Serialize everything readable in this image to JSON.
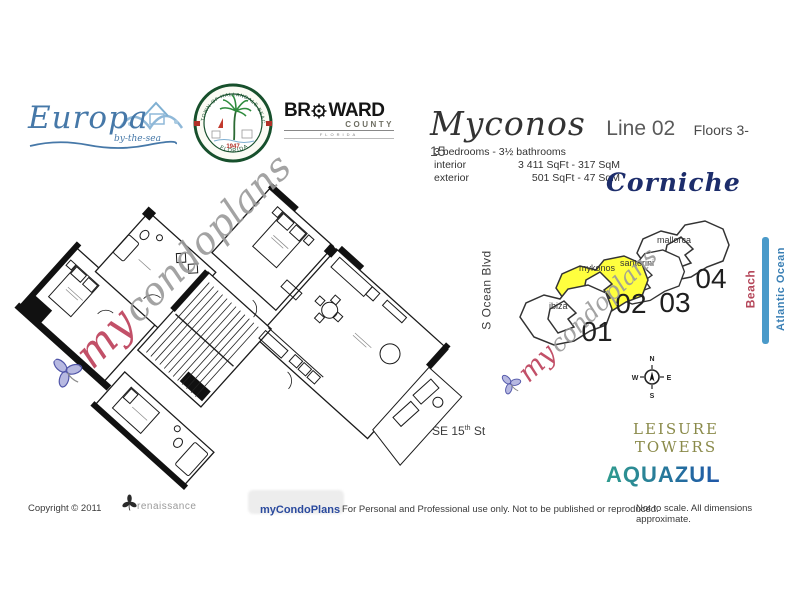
{
  "logos": {
    "europa": {
      "name": "Europa",
      "tagline": "by-the-sea"
    },
    "seal": {
      "top_text": "TOWN OF HALLANDALE BEACH",
      "bottom_text": "FLORIDA",
      "year": "1947"
    },
    "broward": {
      "name_left": "BR",
      "name_right": "WARD",
      "line2": "COUNTY",
      "line3": "FLORIDA"
    }
  },
  "header": {
    "unit_name": "Myconos",
    "line_label": "Line 02",
    "floors_label": "Floors 3-15",
    "bed_bath": "3 bedrooms - 3½ bathrooms",
    "specs": [
      {
        "label": "interior",
        "value": "3 411 SqFt - 317 SqM"
      },
      {
        "label": "exterior",
        "value": "501 SqFt - 47 SqM"
      }
    ]
  },
  "building_name": "Corniche",
  "key_plan": {
    "units": [
      {
        "name": "ibiza",
        "number": "01",
        "highlighted": false
      },
      {
        "name": "mykonos",
        "number": "02",
        "highlighted": true
      },
      {
        "name": "santorini",
        "number": "03",
        "highlighted": false
      },
      {
        "name": "mallorca",
        "number": "04",
        "highlighted": false
      }
    ]
  },
  "compass": {
    "n": "N",
    "s": "S",
    "e": "E",
    "w": "W"
  },
  "map_labels": {
    "street_vertical": "S Ocean Blvd",
    "se15_prefix": "SE 15",
    "se15_sup": "th",
    "se15_suffix": " St",
    "beach": "Beach",
    "ocean": "Atlantic Ocean"
  },
  "nearby": {
    "leisure_line1": "LEISURE",
    "leisure_line2": "TOWERS",
    "aquazul": "AQUAZUL"
  },
  "watermark": {
    "prefix": "my",
    "rest": "condoplans"
  },
  "footer": {
    "copyright": "Copyright © 2011",
    "brand_logo_text": "renaissance",
    "brand": "myCondoPlans",
    "usage": "For Personal and Professional use only.  Not to be published or reproduced.",
    "disclaimer": "Not to scale.  All dimensions approximate."
  },
  "colors": {
    "highlight_yellow": "#ffff3e",
    "europa_blue": "#4678a8",
    "corniche_navy": "#1d2d6b",
    "beach_red": "#b5475a",
    "ocean_blue": "#3b80b5",
    "shore_bar_blue": "#4a9ac9",
    "leisure_olive": "#8a8a4a",
    "aquazul_teal": "#2f9b8e",
    "aquazul_blue": "#1f56a8",
    "brand_blue": "#2a4a9e",
    "watermark_pink": "#c25068",
    "watermark_gray": "#9a9a9a"
  }
}
